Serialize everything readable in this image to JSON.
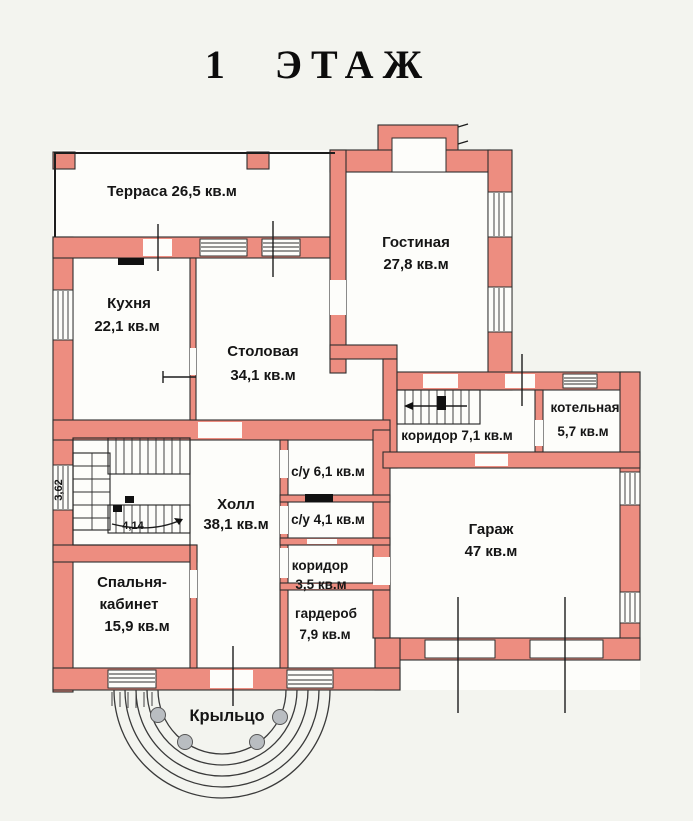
{
  "title": "1  ЭТАЖ",
  "rooms": {
    "terrace": {
      "label": "Терраса 26,5 кв.м"
    },
    "living_room": {
      "name": "Гостиная",
      "area": "27,8 кв.м"
    },
    "kitchen": {
      "name": "Кухня",
      "area": "22,1 кв.м"
    },
    "dining_room": {
      "name": "Столовая",
      "area": "34,1 кв.м"
    },
    "corridor_back": {
      "label": "коридор 7,1 кв.м"
    },
    "boiler_room": {
      "name": "котельная",
      "area": "5,7 кв.м"
    },
    "bathroom_1": {
      "label": "с/у 6,1 кв.м"
    },
    "bathroom_2": {
      "label": "с/у 4,1 кв.м"
    },
    "hall": {
      "name": "Холл",
      "area": "38,1 кв.м"
    },
    "corridor_small": {
      "name": "коридор",
      "area": "3,5 кв.м"
    },
    "wardrobe": {
      "name": "гардероб",
      "area": "7,9 кв.м"
    },
    "bedroom_office": {
      "line1": "Спальня-",
      "line2": "кабинет",
      "area": "15,9 кв.м"
    },
    "garage": {
      "name": "Гараж",
      "area": "47 кв.м"
    },
    "porch": {
      "label": "Крыльцо"
    }
  },
  "stairs": {
    "width_dim": "3,62",
    "run_dim": "4,14"
  },
  "colors": {
    "wall": "#ed8d80",
    "wall_outline": "#2e2e2e",
    "background": "#f3f4ef",
    "room_fill": "#fdfdfa",
    "text": "#151515",
    "porch_column": "#b9bdc1"
  }
}
